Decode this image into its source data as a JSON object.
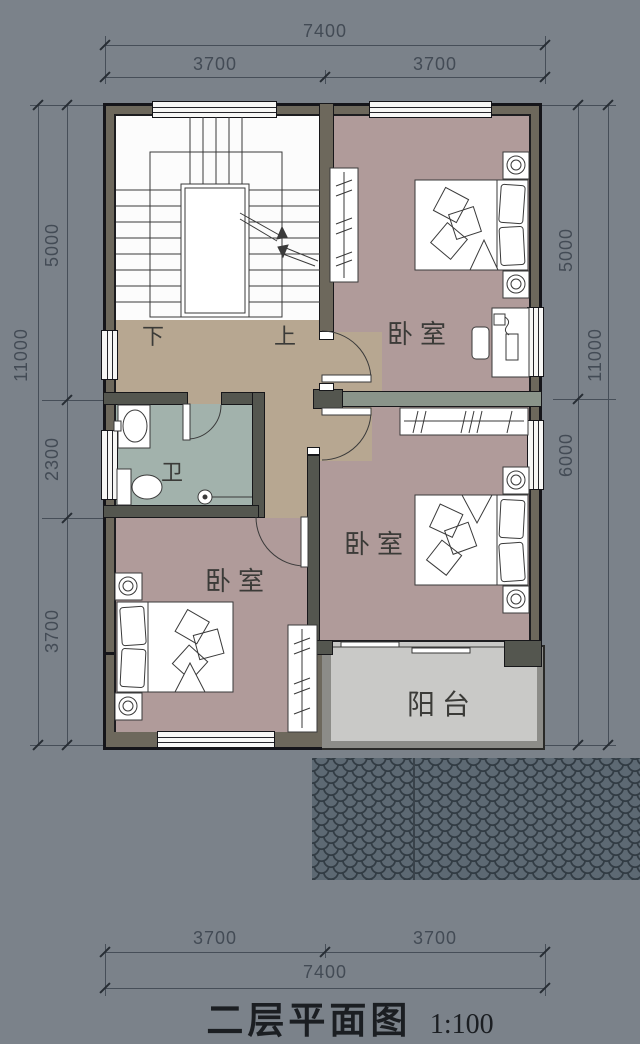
{
  "drawing": {
    "title": "二层平面图",
    "scale": "1:100"
  },
  "dimensions": {
    "top": {
      "overall": "7400",
      "segments": [
        "3700",
        "3700"
      ]
    },
    "bottom": {
      "overall": "7400",
      "segments": [
        "3700",
        "3700"
      ]
    },
    "left": {
      "overall": "11000",
      "segments": [
        "5000",
        "2300",
        "3700"
      ]
    },
    "right": {
      "overall": "11000",
      "segments": [
        "5000",
        "6000"
      ]
    }
  },
  "rooms": {
    "bedroom_top": "卧室",
    "bedroom_middle": "卧室",
    "bedroom_bottom": "卧室",
    "bathroom": "卫",
    "balcony": "阳台"
  },
  "stairs": {
    "down_label": "下",
    "up_label": "上"
  },
  "colors": {
    "background": "#7b828a",
    "wall_fill": "#6d685c",
    "partition_light": "#8a948a",
    "partition_dark": "#54564f",
    "bedroom_floor": "#b09b9a",
    "hall_floor": "#b7a791",
    "bathroom_floor": "#a2b2ac",
    "balcony_floor": "#c9c9c7",
    "roof_tile": "#5d6973",
    "stair_floor": "#fcfcfc",
    "dimension_ink": "#464e58",
    "title_ink": "#1b1e22"
  }
}
